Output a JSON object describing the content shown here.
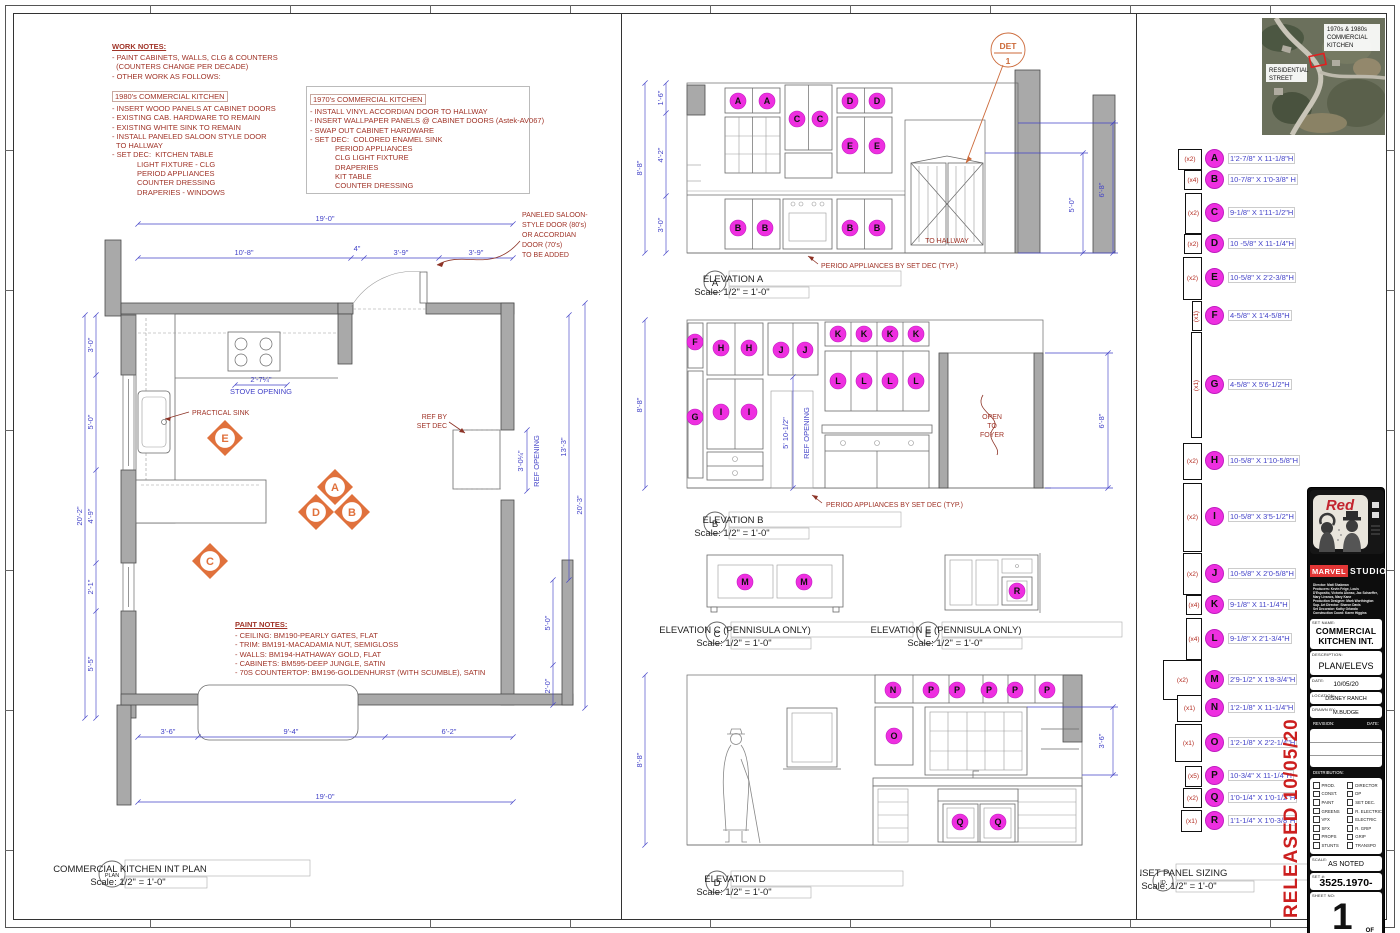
{
  "colors": {
    "dim_blue": "#4343c8",
    "note_red": "#a03428",
    "marker_orange": "#e0713c",
    "panel_magenta": "#ee2fe0",
    "wall_gray": "#a9a9a9",
    "released_red": "#cc1f1f"
  },
  "work_notes": {
    "title": "WORK NOTES:",
    "general": [
      "- PAINT CABINETS, WALLS, CLG & COUNTERS",
      "  (COUNTERS CHANGE PER DECADE)",
      "- OTHER WORK AS FOLLOWS:"
    ],
    "block_1980": {
      "title": "1980's COMMERCIAL KITCHEN",
      "lines": [
        "- INSERT WOOD PANELS AT CABINET DOORS",
        "- EXISTING CAB. HARDWARE TO REMAIN",
        "- EXISTING WHITE SINK TO REMAIN",
        "- INSTALL PANELED SALOON STYLE DOOR",
        "  TO HALLWAY",
        "- SET DEC:  KITCHEN TABLE",
        "            LIGHT FIXTURE - CLG",
        "            PERIOD APPLIANCES",
        "            COUNTER DRESSING",
        "            DRAPERIES - WINDOWS"
      ]
    },
    "block_1970": {
      "title": "1970's COMMERCIAL KITCHEN",
      "lines": [
        "- INSTALL VINYL ACCORDIAN DOOR TO HALLWAY",
        "- INSERT WALLPAPER PANELS @ CABINET DOORS (Astek-AV067)",
        "- SWAP OUT CABINET HARDWARE",
        "- SET DEC:  COLORED ENAMEL SINK",
        "            PERIOD APPLIANCES",
        "            CLG LIGHT FIXTURE",
        "            DRAPERIES",
        "            KIT TABLE",
        "            COUNTER DRESSING"
      ]
    }
  },
  "paint_notes": {
    "title": "PAINT NOTES:",
    "lines": [
      "- CEILING: BM190-PEARLY GATES, FLAT",
      "- TRIM: BM191-MACADAMIA NUT, SEMIGLOSS",
      "- WALLS: BM194-HATHAWAY GOLD, FLAT",
      "- CABINETS: BM595-DEEP JUNGLE, SATIN",
      "- 70S COUNTERTOP: BM196-GOLDENHURST (WITH SCUMBLE), SATIN"
    ]
  },
  "plan": {
    "bubble": "PLAN",
    "title": "COMMERCIAL KITCHEN INT PLAN",
    "scale": "Scale: 1/2\" = 1'-0\"",
    "dims": {
      "top_overall": "19'-0\"",
      "top_segs": [
        "10'-8\"",
        "4\"",
        "3'-9\"",
        "3'-9\""
      ],
      "left_overall": "20'-2\"",
      "left_segs": [
        "3'-0\"",
        "5'-0\"",
        "4'-9\"",
        "2'-1\"",
        "5'-5\""
      ],
      "right_13": "13'-3\"",
      "right_20": "20'-3\"",
      "right_5": "5'-0\"",
      "right_2": "2'-0\"",
      "ref_w": "3'-0¼\"",
      "stove_w": "2'-7¼\"",
      "bottom_segs": [
        "3'-6\"",
        "9'-4\"",
        "6'-2\""
      ],
      "bottom_overall": "19'-0\""
    },
    "labels": {
      "stove": "STOVE OPENING",
      "sink": "PRACTICAL SINK",
      "ref_by": "REF BY",
      "set_dec": "SET DEC",
      "ref_opening": "REF OPENING",
      "door_note": [
        "PANELED SALOON-",
        "STYLE DOOR (80's)",
        "OR ACCORDIAN",
        "DOOR (70's)",
        "TO BE ADDED"
      ]
    },
    "markers": {
      "a": "A",
      "b": "B",
      "c": "C",
      "d": "D",
      "e": "E"
    }
  },
  "elev_a": {
    "bubble": "A",
    "title": "ELEVATION A",
    "scale": "Scale: 1/2\" = 1'-0\"",
    "labels": [
      "A",
      "A",
      "C",
      "C",
      "D",
      "D",
      "E",
      "E",
      "B",
      "B",
      "B",
      "B"
    ],
    "to_hallway": "TO HALLWAY",
    "det_top": "DET",
    "det_num": "1",
    "note": "PERIOD APPLIANCES BY SET DEC (TYP.)",
    "dim_overall": "8'-8\"",
    "dim_segs": [
      "1'-6\"",
      "4'-2\"",
      "3'-0\""
    ],
    "dim_r1": "5'-0\"",
    "dim_r2": "6'-8\""
  },
  "elev_b": {
    "bubble": "B",
    "title": "ELEVATION B",
    "scale": "Scale: 1/2\" = 1'-0\"",
    "labels_top": [
      "F",
      "H",
      "H",
      "J",
      "J"
    ],
    "labels_k": [
      "K",
      "K",
      "K",
      "K"
    ],
    "labels_l": [
      "L",
      "L",
      "L",
      "L"
    ],
    "labels_mid": [
      "G",
      "I",
      "I"
    ],
    "ref_dim": "5' 10-1/2\"",
    "ref_label": "REF OPENING",
    "open_foyer": [
      "OPEN",
      "TO",
      "FOYER"
    ],
    "note": "PERIOD APPLIANCES BY SET DEC (TYP.)",
    "dim_left": "8'-8\"",
    "dim_right": "6'-8\""
  },
  "elev_c": {
    "bubble": "C",
    "title": "ELEVATION C (PENNISULA ONLY)",
    "scale": "Scale: 1/2\" = 1'-0\"",
    "labels": [
      "M",
      "M"
    ]
  },
  "elev_e": {
    "bubble": "E",
    "title": "ELEVATION E (PENNISULA ONLY)",
    "scale": "Scale: 1/2\" = 1'-0\"",
    "labels": [
      "R"
    ]
  },
  "elev_d": {
    "bubble": "D",
    "title": "ELEVATION D",
    "scale": "Scale: 1/2\" = 1'-0\"",
    "labels_top": [
      "N",
      "P",
      "P",
      "P",
      "P",
      "P"
    ],
    "label_o": "O",
    "labels_q": [
      "Q",
      "Q"
    ],
    "dim_left": "8'-8\"",
    "dim_right": "3'-6\""
  },
  "sizing": {
    "bubble": "ID",
    "title": "INSET PANEL SIZING",
    "scale": "Scale: 1/2\" = 1'-0\"",
    "rows": [
      {
        "letter": "A",
        "count": "(x2)",
        "size": "1'2-7/8\" X 11-1/8\"H"
      },
      {
        "letter": "B",
        "count": "(x4)",
        "size": "10-7/8\" X 1'0-3/8\" H"
      },
      {
        "letter": "C",
        "count": "(x2)",
        "size": "9-1/8\" X 1'11-1/2\"H"
      },
      {
        "letter": "D",
        "count": "(x2)",
        "size": "10 -5/8\" X 11-1/4\"H"
      },
      {
        "letter": "E",
        "count": "(x2)",
        "size": "10-5/8\" X 2'2-3/8\"H"
      },
      {
        "letter": "F",
        "count": "(x1)",
        "size": "4-5/8\" X 1'4-5/8\"H"
      },
      {
        "letter": "G",
        "count": "(x1)",
        "size": "4-5/8\" X 5'6-1/2\"H"
      },
      {
        "letter": "H",
        "count": "(x2)",
        "size": "10-5/8\" X 1'10-5/8\"H"
      },
      {
        "letter": "I",
        "count": "(x2)",
        "size": "10-5/8\" X 3'5-1/2\"H"
      },
      {
        "letter": "J",
        "count": "(x2)",
        "size": "10-5/8\" X 2'0-5/8\"H"
      },
      {
        "letter": "K",
        "count": "(x4)",
        "size": "9-1/8\" X 11-1/4\"H"
      },
      {
        "letter": "L",
        "count": "(x4)",
        "size": "9-1/8\" X 2'1-3/4\"H"
      },
      {
        "letter": "M",
        "count": "(x2)",
        "size": "2'9-1/2\" X 1'8-3/4\"H"
      },
      {
        "letter": "N",
        "count": "(x1)",
        "size": "1'2-1/8\" X 11-1/4\"H"
      },
      {
        "letter": "O",
        "count": "(x1)",
        "size": "1'2-1/8\" X 2'2-1/4\"H"
      },
      {
        "letter": "P",
        "count": "(x5)",
        "size": "10-3/4\" X 11-1/4\"H"
      },
      {
        "letter": "Q",
        "count": "(x2)",
        "size": "1'0-1/4\" X 1'0-1/2\"H"
      },
      {
        "letter": "R",
        "count": "(x1)",
        "size": "1'1-1/4\" X 1'0-3/8\"H"
      }
    ]
  },
  "released": "RELEASED 10/05/20",
  "map": {
    "label1": [
      "1970s & 1980s",
      "COMMERCIAL",
      "KITCHEN"
    ],
    "label2": [
      "RESIDENTIAL",
      "STREET"
    ]
  },
  "titleblock": {
    "tv_logo": "Red",
    "studio_word1": "MARVEL",
    "studio_word2": "STUDIOS",
    "credits": [
      "Director: Matt Shakman",
      "Producers: Kevin Feige, Louis",
      "D'Esposito, Victoria Alonso, Jac Schaeffer,",
      "Mary Livanos, Mary Kane",
      "Production Designer: Mark Worthington",
      "Sup. Art Director: Sharon Davis",
      "Set Decorator: Kathy Orlando",
      "Construction Coord: Karen Higgins"
    ],
    "set_name_label": "SET NAME:",
    "set_name_1": "COMMERCIAL",
    "set_name_2": "KITCHEN  INT.",
    "description_label": "DESCRIPTION:",
    "description": "PLAN/ELEVS",
    "date_label": "DATE:",
    "date": "10/05/20",
    "location_label": "LOCATION:",
    "location": "DISNEY RANCH",
    "drawn_label": "DRAWN BY:",
    "drawn": "M.BUDGE",
    "revision_label": "REVISION:",
    "rev_date_label": "DATE:",
    "distribution_label": "DISTRIBUTION:",
    "dist_left": [
      "PROD.",
      "CONST.",
      "PAINT",
      "GREENS",
      "VFX",
      "SFX",
      "PROPS",
      "STUNTS"
    ],
    "dist_right": [
      "DIRECTOR",
      "DP",
      "SET DEC.",
      "R. ELECTRIC",
      "ELECTRIC",
      "R. GRIP",
      "GRIP",
      "TRANSPO"
    ],
    "scale_label": "SCALE:",
    "scale": "AS NOTED",
    "set_num_label": "SET #:",
    "set_num": "3525.1970-1980",
    "sheet_label": "SHEET NO:",
    "sheet": "1",
    "of_label": "OF"
  }
}
